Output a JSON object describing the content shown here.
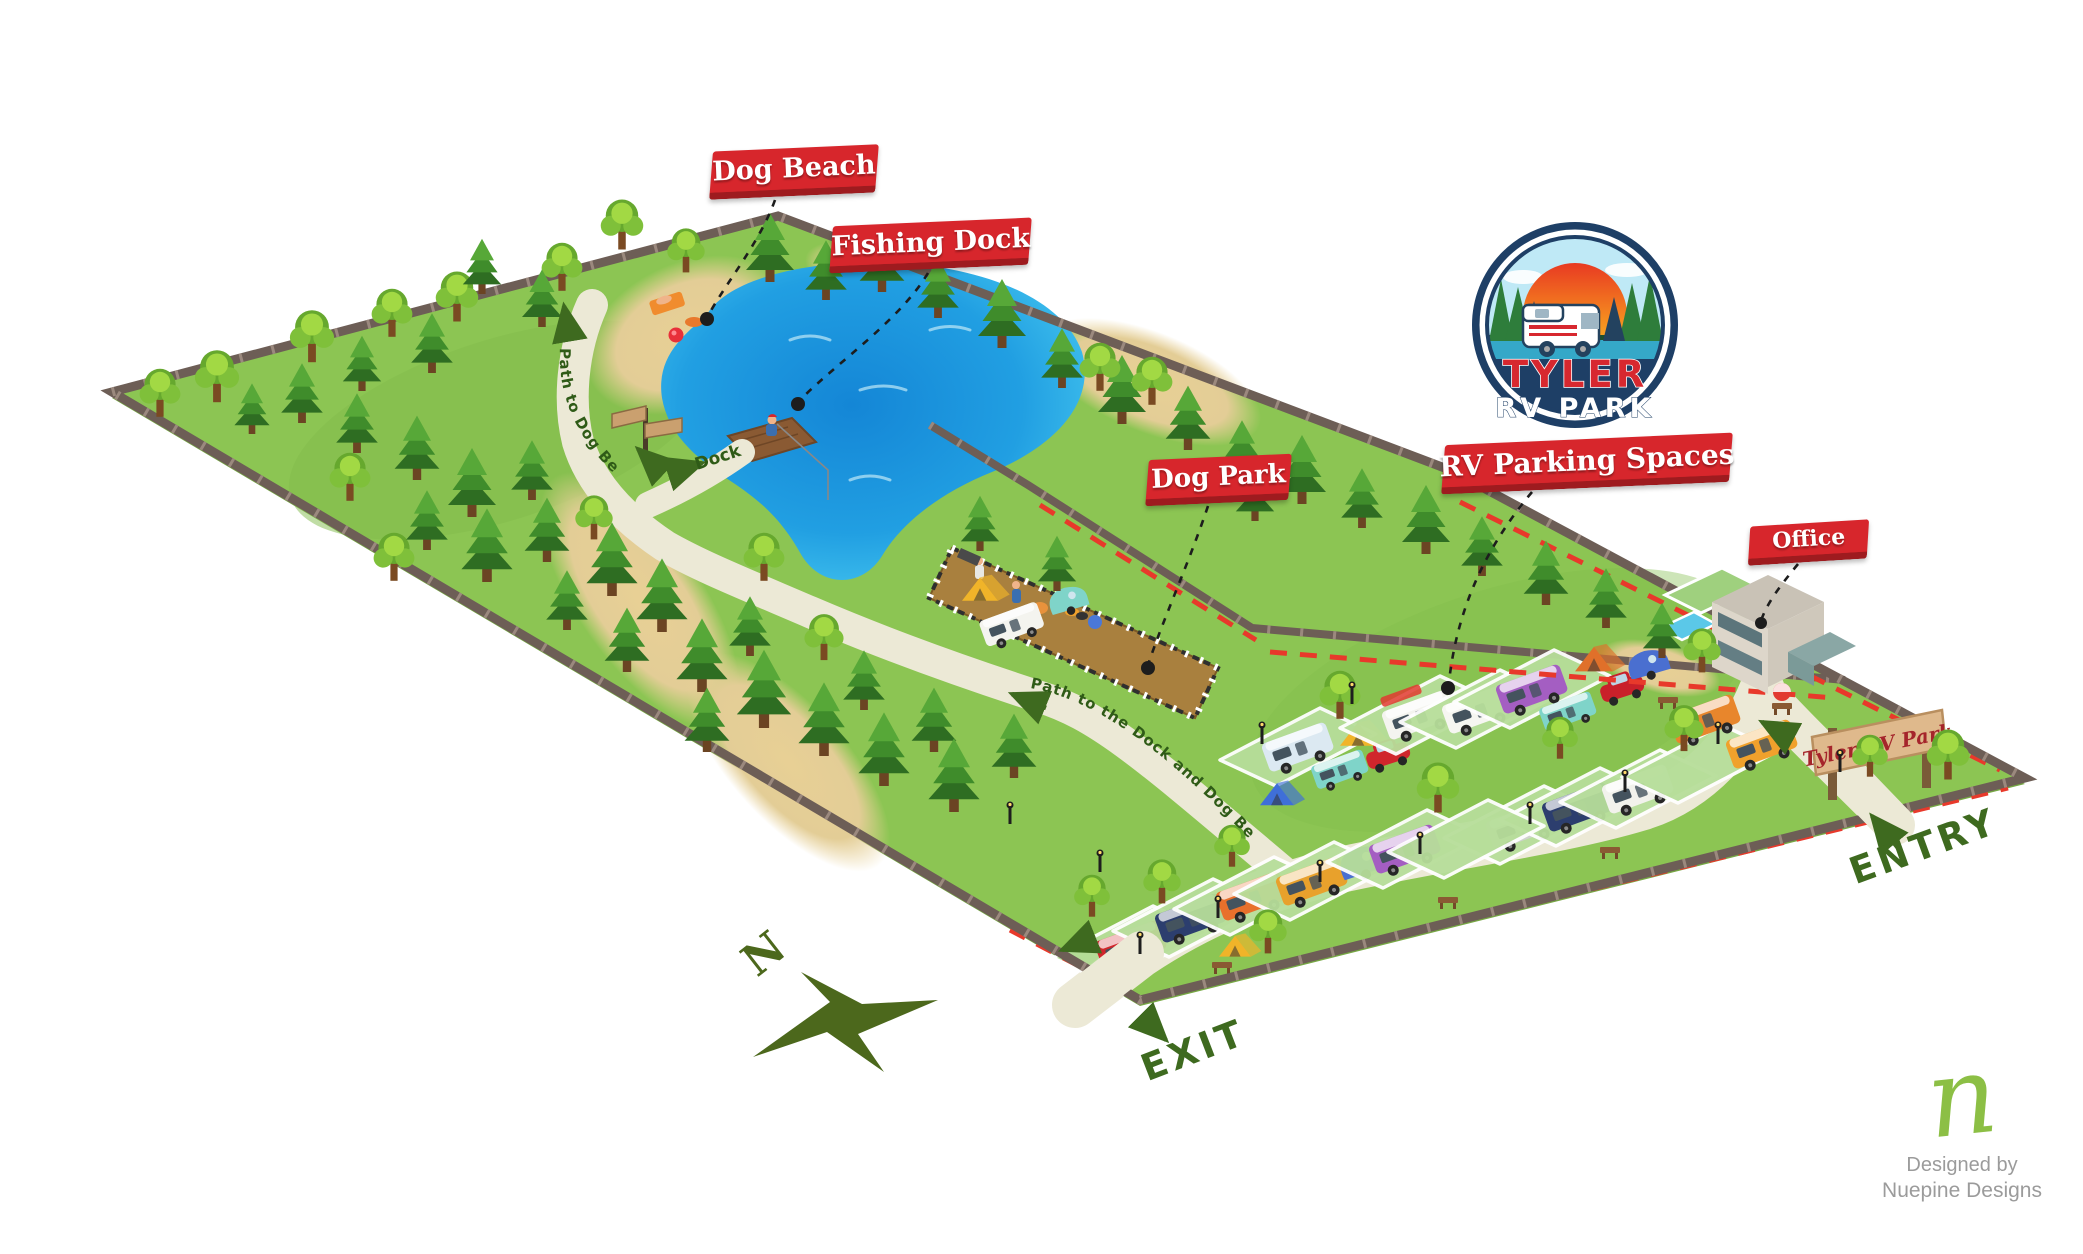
{
  "title": "Tyler RV Park illustrated map",
  "legend_labels": {
    "dog_beach": "Dog Beach",
    "fishing_dock": "Fishing Dock",
    "dog_park": "Dog Park",
    "rv_parking": "RV Parking Spaces",
    "office": "Office"
  },
  "path_labels": {
    "path_to_dog_beach": "Path to Dog Beach",
    "dock": "Dock",
    "path_to_dock_and_dog_beach": "Path to the Dock and Dog Beach"
  },
  "signs": {
    "entrance_sign": "Tyler RV Park",
    "entry": "ENTRY",
    "exit": "EXIT"
  },
  "compass": {
    "north": "N"
  },
  "logo": {
    "line1": "TYLER",
    "line2": "RV PARK"
  },
  "credit": {
    "monogram": "n",
    "line1": "Designed by",
    "line2": "Nuepine Designs"
  },
  "colors": {
    "banner_red": "#d7262c",
    "banner_red_shadow": "#9e1b1f",
    "grass": "#8cc553",
    "sand": "#e8d095",
    "lake_edge": "#45c6ef",
    "lake_deep": "#1486d6",
    "path_cream": "#ece9d6",
    "fence_brown": "#6d5e56",
    "dash_red": "#e8392b",
    "map_text_green": "#3e6a1f",
    "dog_park_dirt": "#a9803e",
    "logo_navy": "#1e3f66",
    "logo_red": "#d7282f",
    "credit_green": "#8cbf45",
    "credit_gray": "#9b9b9b"
  }
}
